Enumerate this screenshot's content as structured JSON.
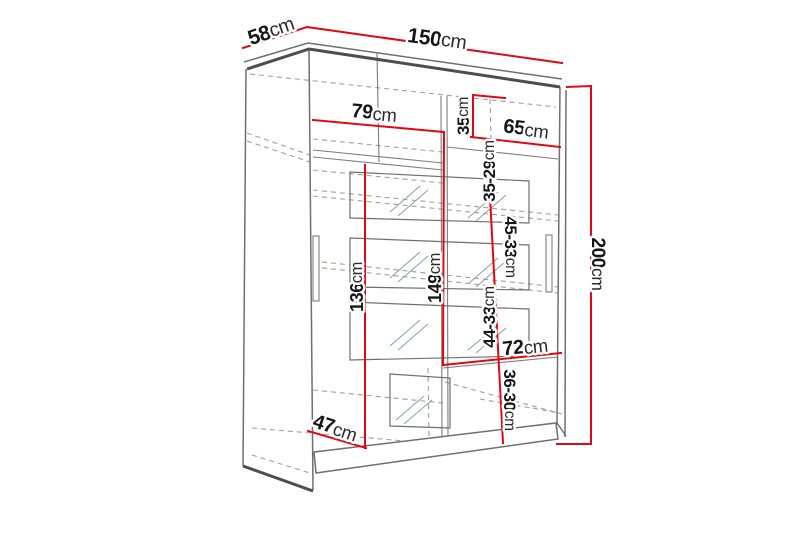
{
  "figure": {
    "type": "furniture-dimension-diagram",
    "subject": "two-door sliding wardrobe with mirror strips, shelves and hanging section",
    "canvas": {
      "width": 800,
      "height": 533,
      "background": "#ffffff"
    },
    "palette": {
      "dimension_red": "#e30613",
      "outline_dark": "#4d4d4d",
      "outline_mid": "#6f6f6f",
      "line_thin": "#7d7d7d",
      "dashed_gray": "#a09f99",
      "hatch_gray": "#93a0a6",
      "text_black": "#161616",
      "label_halo": "#ffffff"
    },
    "dimensions": [
      {
        "id": "depth-58cm",
        "value": "58",
        "unit": "cm",
        "x": 271,
        "y": 31,
        "rotate": -19,
        "size": 21
      },
      {
        "id": "width-150cm",
        "value": "150",
        "unit": "cm",
        "x": 437,
        "y": 39,
        "rotate": 8,
        "size": 21
      },
      {
        "id": "inner-width-left-79cm",
        "value": "79",
        "unit": "cm",
        "x": 374,
        "y": 113,
        "rotate": 5,
        "size": 20
      },
      {
        "id": "top-shelf-35cm",
        "value": "35",
        "unit": "cm",
        "x": 463,
        "y": 116,
        "rotate": -90,
        "size": 17
      },
      {
        "id": "inner-width-right-65cm",
        "value": "65",
        "unit": "cm",
        "x": 526,
        "y": 129,
        "rotate": 7,
        "size": 20
      },
      {
        "id": "shelf-gap-35-29cm",
        "value": "35-29",
        "unit": "cm",
        "x": 489,
        "y": 171,
        "rotate": -90,
        "size": 17
      },
      {
        "id": "shelf-gap-45-33cm",
        "value": "45-33",
        "unit": "cm",
        "x": 511,
        "y": 247,
        "rotate": 90,
        "size": 17
      },
      {
        "id": "inner-height-left-136cm",
        "value": "136",
        "unit": "cm",
        "x": 357,
        "y": 287,
        "rotate": -90,
        "size": 18
      },
      {
        "id": "inner-height-149cm",
        "value": "149",
        "unit": "cm",
        "x": 435,
        "y": 278,
        "rotate": -90,
        "size": 18
      },
      {
        "id": "shelf-gap-44-33cm",
        "value": "44-33",
        "unit": "cm",
        "x": 489,
        "y": 317,
        "rotate": -90,
        "size": 17
      },
      {
        "id": "bottom-shelf-72cm",
        "value": "72",
        "unit": "cm",
        "x": 525,
        "y": 347,
        "rotate": -6,
        "size": 20
      },
      {
        "id": "shelf-gap-36-30cm",
        "value": "36-30",
        "unit": "cm",
        "x": 510,
        "y": 400,
        "rotate": 90,
        "size": 17
      },
      {
        "id": "inner-depth-47cm",
        "value": "47",
        "unit": "cm",
        "x": 335,
        "y": 428,
        "rotate": 18,
        "size": 20
      },
      {
        "id": "height-200cm",
        "value": "200",
        "unit": "cm",
        "x": 598,
        "y": 264,
        "rotate": 90,
        "size": 19
      }
    ],
    "dimension_lines": [
      {
        "id": "line-58cm",
        "points": "243,48 307,27"
      },
      {
        "id": "line-150cm",
        "points": "307,27 562,63"
      },
      {
        "id": "line-200cm",
        "points": "567,87 591,86 591,444 557,444"
      },
      {
        "id": "line-79cm",
        "points": "313,120 444,132"
      },
      {
        "id": "line-149cm",
        "points": "444,132 443,365"
      },
      {
        "id": "line-35cm",
        "points": "505,98 473,95 473,137"
      },
      {
        "id": "line-65cm",
        "points": "471,137 560,147"
      },
      {
        "id": "line-shelf-gaps",
        "points": "487,140 503,443"
      },
      {
        "id": "line-72cm",
        "points": "443,365 561,353"
      },
      {
        "id": "line-136cm",
        "points": "365,165 365,448"
      },
      {
        "id": "line-47cm",
        "points": "308,431 366,448"
      }
    ],
    "structure": {
      "thick": [
        "247,69 309,49 560,87",
        "243,466 313,491"
      ],
      "medium": [
        "244,62 308,43 562,79",
        "246,69 243,466",
        "309,48 313,490",
        "560,87 557,423",
        "566,90 565,437",
        "557,423 566,436"
      ],
      "thin": [
        "313,150 443,163",
        "313,157 443,170",
        "447,147 558,159",
        "443,368 558,357",
        "441,96 442,445",
        "447,96 448,442",
        "377,52 379,162"
      ],
      "dashed": [
        "250,74 556,107",
        "247,133 310,155",
        "247,141 310,162",
        "313,139 443,152",
        "313,170 443,183",
        "313,190 558,215",
        "313,196 558,221",
        "313,261 558,287",
        "313,267 558,293",
        "490,99 491,138",
        "428,368 429,438",
        "313,390 443,403",
        "252,428 440,444",
        "252,455 310,473",
        "445,440 556,423",
        "445,382 562,414",
        "480,399 560,413"
      ],
      "plinth": "314,452 556,423 558,439 316,473",
      "mirror_panels": [
        "350,172 529,181 529,223 350,218",
        "350,238 529,245 529,290 350,287",
        "350,302 529,309 529,356 350,360",
        "390,374 450,378 450,428 390,426"
      ],
      "hatches": [
        "390,212 420,186",
        "398,216 428,190",
        "468,218 498,192",
        "476,221 506,195",
        "390,278 420,252",
        "398,282 428,256",
        "468,284 498,258",
        "476,287 506,261",
        "390,346 420,320",
        "398,350 428,324",
        "468,350 498,325",
        "476,353 506,328",
        "396,420 424,396",
        "404,424 432,400"
      ],
      "handles": [
        "313,236 319,236 319,301 313,301",
        "546,235 552,235 552,292 546,292"
      ]
    }
  }
}
